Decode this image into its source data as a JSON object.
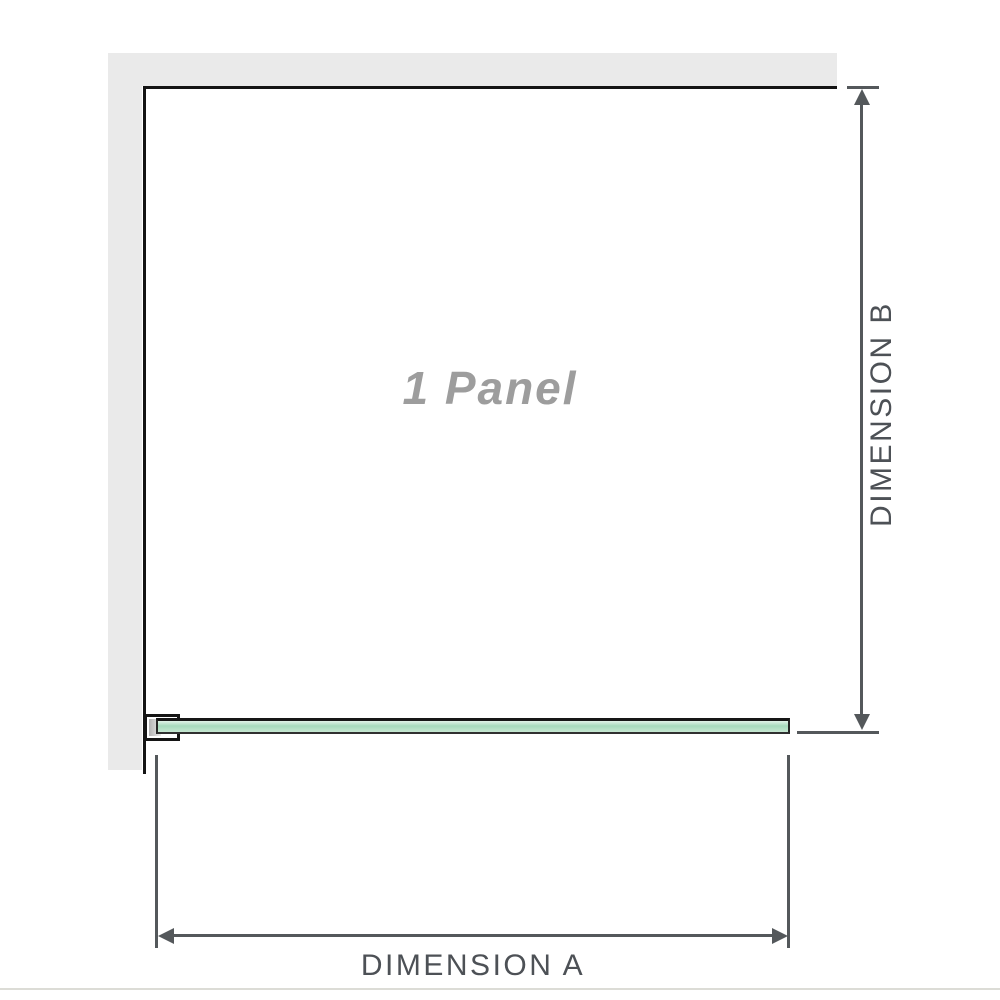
{
  "diagram": {
    "panel_label": "1 Panel",
    "dimension_a_label": "DIMENSION A",
    "dimension_b_label": "DIMENSION B"
  },
  "colors": {
    "wall": "#eaeaea",
    "outline": "#141414",
    "dim": "#54585b",
    "dim_text": "#4d5156",
    "panel_text": "#9d9d9d",
    "glass_top": "#e2f3e9",
    "glass_mid": "#a6dabc",
    "glass_low": "#c6e7d2",
    "baseline": "#dcdcd6"
  }
}
